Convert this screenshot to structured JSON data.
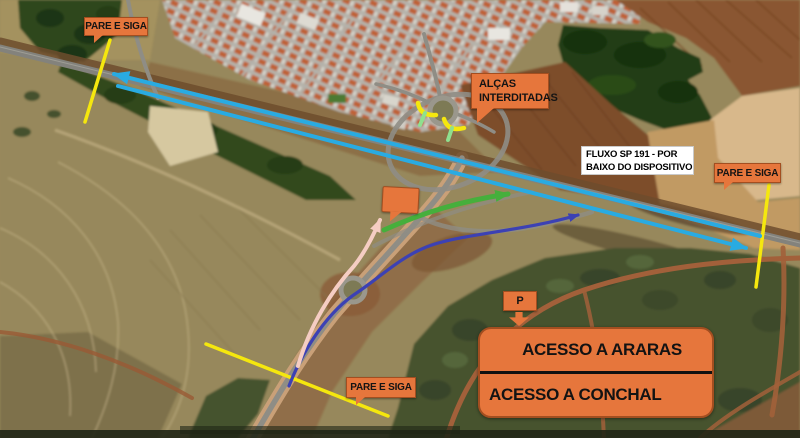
{
  "map": {
    "description": "Satellite traffic-control plan of an SP-191 highway interchange: closed loop ramps, stop-and-go points and detour routes drawn over aerial imagery",
    "colors": {
      "callout_orange": "#E6763C",
      "callout_border": "#A34E20",
      "callout_text": "#141414",
      "info_box_bg": "#FFFFFF",
      "flow_arrow_cyan": "#29ABE2",
      "stop_line_yellow": "#F5E70E",
      "ramp_open_green": "#8FE08F",
      "route_green": "#46AF3C",
      "route_indigo": "#3C41B4",
      "route_pink": "#F5CDC3"
    }
  },
  "labels": {
    "stop_go_top_left": "PARE E SIGA",
    "stop_go_right": "PARE E SIGA",
    "stop_go_bottom": "PARE E SIGA",
    "ramps_line1": "ALÇAS",
    "ramps_line2": "INTERDITADAS",
    "flow_line1": "FLUXO SP 191 - POR",
    "flow_line2": "BAIXO DO DISPOSITIVO",
    "p_marker": "P",
    "access_row1": "ACESSO A ARARAS",
    "access_row2": "ACESSO A CONCHAL"
  },
  "icons": {
    "device_marker": "orange-callout-marker",
    "p_arrow": "down-arrow",
    "flow_west": "cyan-arrow-left",
    "flow_east": "cyan-arrow-right",
    "detour_green": "green-curved-arrow",
    "detour_indigo": "indigo-route-arrow",
    "detour_pink": "pink-route-arrow",
    "closure_marks": "yellow-stop-lines"
  }
}
